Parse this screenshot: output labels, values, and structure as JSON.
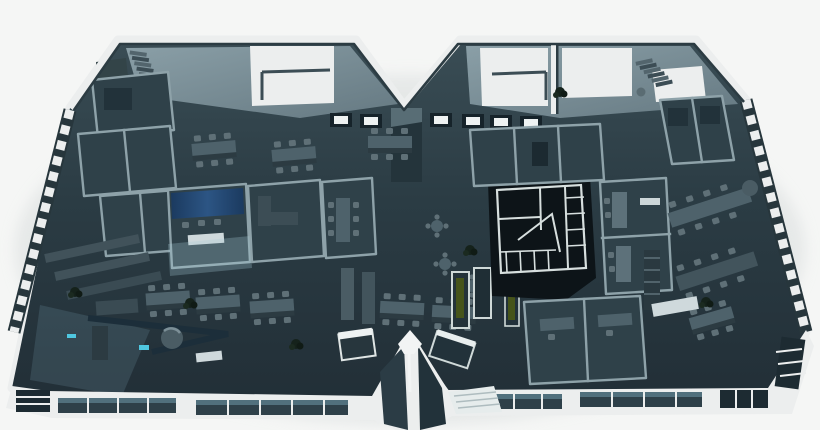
{
  "meta": {
    "title": "3D isometric office floor plan render",
    "subject": "Top-down cutaway render of a twin-wing office floor on a white background",
    "background": "#f5f6f5",
    "canvas": {
      "width": 820,
      "height": 430
    }
  },
  "palette": {
    "bg": "#f5f6f5",
    "shell": "#eceeee",
    "shell_dim": "#d9dedf",
    "floor_top": "#3a4d55",
    "floor_bot": "#222f37",
    "room_floor": "#2f4149",
    "wall_cap": "#8ea2a9",
    "wall_dark": "#17242b",
    "wall_mid": "#45575f",
    "furn_top": "#4e626b",
    "furn_side": "#2c3b42",
    "furn_light": "#5d717a",
    "chair": "#5f7077",
    "glass": "#6b7f88",
    "glass_light": "#93a8b0",
    "window": "#2e4049",
    "pane": "#51707d",
    "accent_blue": "#2c5584",
    "accent_blue_dark": "#1b3a5f",
    "accent_cyan": "#4fc7e0",
    "accent_olive": "#46541a",
    "core_black": "#0d1418",
    "core_trim": "#d7dfde",
    "plant": "#15221b",
    "shadow": "#d7dbdb"
  },
  "scene": {
    "building_shape": "twin-wing floor plate joined at a narrow waist: V-shaped notch in the top edge, peaked glass bay at the bottom center",
    "view": "aerial axonometric cutaway, roof removed except perimeter frame",
    "elements": [
      {
        "name": "roof-frame",
        "desc": "white perimeter roof beams forming the M-shaped top edge"
      },
      {
        "name": "atrium-left",
        "desc": "double-height void with glass roof panel, guard railing and staircase"
      },
      {
        "name": "atrium-right",
        "desc": "mirrored double-height void with railing, divider beam and staircase"
      },
      {
        "name": "skylight-row",
        "desc": "framed skylight openings along the waist of the plate"
      },
      {
        "name": "elevator-core",
        "desc": "dark shaft block below the top notch"
      },
      {
        "name": "meeting-room-blue-wall",
        "desc": "glass meeting room with royal-blue feature wall, left wing"
      },
      {
        "name": "core-block-black",
        "desc": "near-black service core with white-trimmed maze of partitions, right wing"
      },
      {
        "name": "phone-booths-olive",
        "desc": "small booths with dark olive-green panels near bottom center"
      },
      {
        "name": "open-plan-desks",
        "desc": "banks of desks with task chairs in both wings"
      },
      {
        "name": "long-meeting-tables",
        "desc": "long tables with chair rows in the center and right wing"
      },
      {
        "name": "cafe-round-tables",
        "desc": "small round tables with four seats near the core"
      },
      {
        "name": "lounge-bottom-left",
        "desc": "angled navy partition, sofas and a cylindrical column"
      },
      {
        "name": "perimeter-window-stripes",
        "desc": "striped mullion pattern along the slanted left and right edges"
      },
      {
        "name": "facade-windows-south",
        "desc": "white parapet band with dark glazing strips along the bottom facade"
      },
      {
        "name": "center-glass-peak",
        "desc": "white peaked bay with dark glass at the bottom center"
      },
      {
        "name": "planters",
        "desc": "dark potted plants scattered on the floor plate"
      }
    ]
  }
}
